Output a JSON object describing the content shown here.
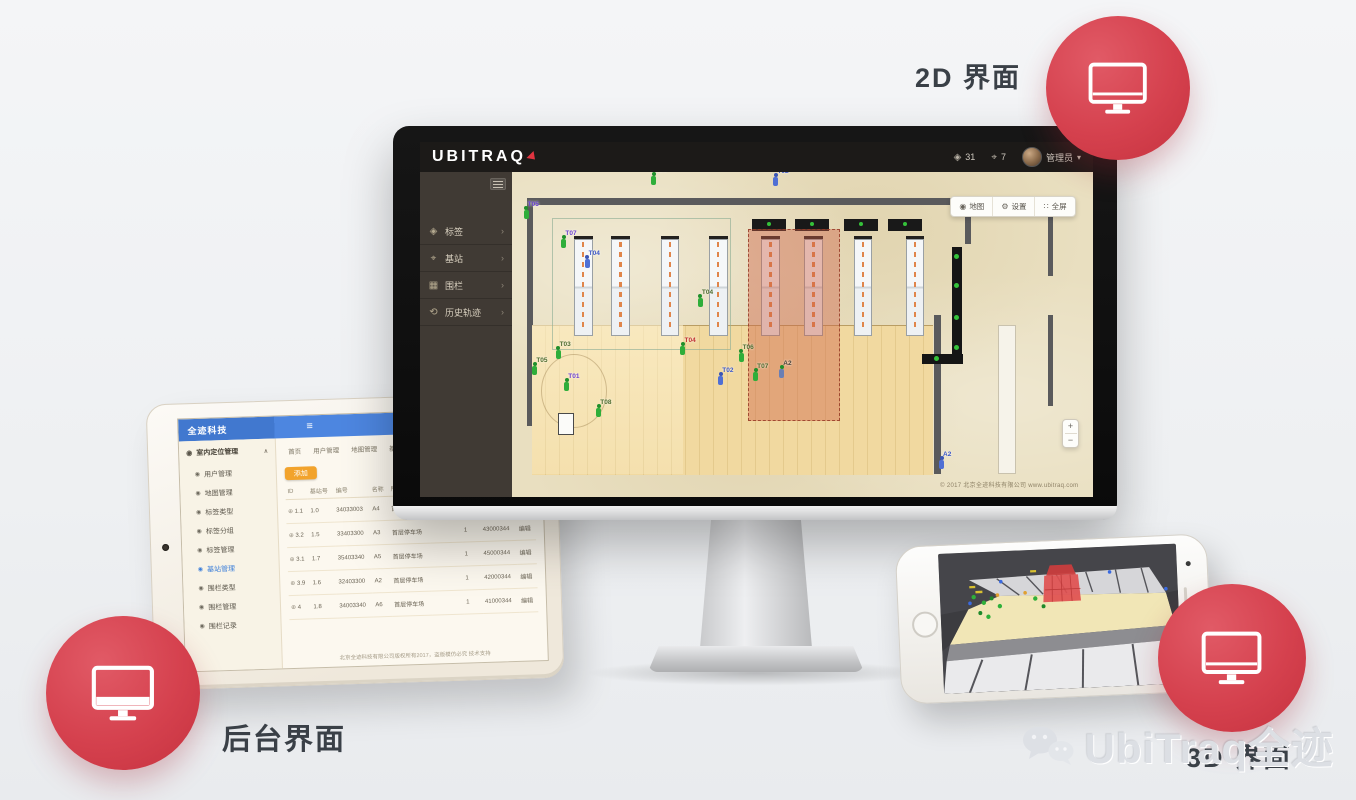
{
  "scene": {
    "label_2d": "2D 界面",
    "label_backend": "后台界面",
    "label_3d": "3D 界面",
    "watermark_text": "UbiTraq全迹",
    "accent_red": "#d5414e"
  },
  "monitor_app": {
    "brand": "UBITRAQ",
    "topbar": {
      "tag_count": "31",
      "anchor_count": "7",
      "user_name": "管理员",
      "caret": "▾"
    },
    "sidebar_items": [
      {
        "icon": "tag-icon",
        "glyph": "◈",
        "label": "标签",
        "chevron": "›"
      },
      {
        "icon": "anchor-icon",
        "glyph": "⌖",
        "label": "基站",
        "chevron": "›"
      },
      {
        "icon": "fence-icon",
        "glyph": "▦",
        "label": "围栏",
        "chevron": "›"
      },
      {
        "icon": "history-track-icon",
        "glyph": "⟲",
        "label": "历史轨迹",
        "chevron": "›"
      }
    ],
    "map_toolbar": [
      {
        "icon": "map-pin-icon",
        "glyph": "◉",
        "label": "地图"
      },
      {
        "icon": "settings-gear-icon",
        "glyph": "⚙",
        "label": "设置"
      },
      {
        "icon": "fullscreen-icon",
        "glyph": "∷",
        "label": "全屏"
      }
    ],
    "zoom_in": "+",
    "zoom_out": "−",
    "map_credit": "© 2017 北京全迹科技有限公司 www.ubitraq.com",
    "markers": [
      {
        "label": "T04",
        "x": 24,
        "y": 0.5,
        "cls": "purple"
      },
      {
        "label": "T02",
        "x": 45,
        "y": 1,
        "cls": "blue"
      },
      {
        "label": "T05",
        "x": 2,
        "y": 11,
        "cls": "purple"
      },
      {
        "label": "T07",
        "x": 8.5,
        "y": 20,
        "cls": "purple"
      },
      {
        "label": "T04",
        "x": 12.5,
        "y": 26,
        "cls": "blue"
      },
      {
        "label": "T04",
        "x": 32,
        "y": 38,
        "cls": "green"
      },
      {
        "label": "T04",
        "x": 29,
        "y": 53,
        "cls": "red"
      },
      {
        "label": "T02",
        "x": 35.5,
        "y": 62,
        "cls": "blue"
      },
      {
        "label": "A2",
        "x": 46,
        "y": 60,
        "cls": "dark"
      },
      {
        "label": "T03",
        "x": 7.5,
        "y": 54,
        "cls": "green"
      },
      {
        "label": "T05",
        "x": 3.5,
        "y": 59,
        "cls": "green"
      },
      {
        "label": "T01",
        "x": 9,
        "y": 64,
        "cls": "purple"
      },
      {
        "label": "T08",
        "x": 14.5,
        "y": 72,
        "cls": "green"
      },
      {
        "label": "T06",
        "x": 39,
        "y": 55,
        "cls": "green"
      },
      {
        "label": "T07",
        "x": 41.5,
        "y": 61,
        "cls": "green"
      },
      {
        "label": "A2",
        "x": 73.5,
        "y": 88,
        "cls": "blue"
      }
    ]
  },
  "tablet_app": {
    "header_title": "全迹科技",
    "menu_group": "室内定位管理",
    "menu_group_caret": "∧",
    "menu_items": [
      {
        "label": "用户管理"
      },
      {
        "label": "地图管理"
      },
      {
        "label": "标签类型"
      },
      {
        "label": "标签分组"
      },
      {
        "label": "标签管理"
      },
      {
        "label": "基站管理",
        "active": true
      },
      {
        "label": "围栏类型"
      },
      {
        "label": "围栏管理"
      },
      {
        "label": "围栏记录"
      }
    ],
    "tabs": [
      {
        "label": "首页"
      },
      {
        "label": "用户管理"
      },
      {
        "label": "地图管理"
      },
      {
        "label": "基站类型"
      },
      {
        "label": "标签管理"
      },
      {
        "label": "标签分组"
      },
      {
        "label": "基站管理 ×",
        "active": true
      }
    ],
    "add_button": "添加",
    "table": {
      "headers": [
        "ID",
        "基站号",
        "编号",
        "名称",
        "所属地图",
        "颜色",
        "楼层",
        "mac地址",
        "操作"
      ],
      "rows": [
        {
          "id": "1.1",
          "bs": "1.0",
          "code": "34033003",
          "name": "A4",
          "map": "首层停车场",
          "color": "#da7079",
          "floor": "1",
          "mac": "44000344",
          "op": "编辑"
        },
        {
          "id": "3.2",
          "bs": "1.5",
          "code": "33403300",
          "name": "A3",
          "map": "首层停车场",
          "color": "",
          "floor": "1",
          "mac": "43000344",
          "op": "编辑"
        },
        {
          "id": "3.1",
          "bs": "1.7",
          "code": "35403340",
          "name": "A5",
          "map": "首层停车场",
          "color": "",
          "floor": "1",
          "mac": "45000344",
          "op": "编辑"
        },
        {
          "id": "3.9",
          "bs": "1.6",
          "code": "32403300",
          "name": "A2",
          "map": "首层停车场",
          "color": "",
          "floor": "1",
          "mac": "42000344",
          "op": "编辑"
        },
        {
          "id": "4",
          "bs": "1.8",
          "code": "34003340",
          "name": "A6",
          "map": "首层停车场",
          "color": "",
          "floor": "1",
          "mac": "41000344",
          "op": "编辑"
        }
      ]
    },
    "footer": "北京全迹科技有限公司版权所有2017，盗版模仿必究 技术支持"
  }
}
